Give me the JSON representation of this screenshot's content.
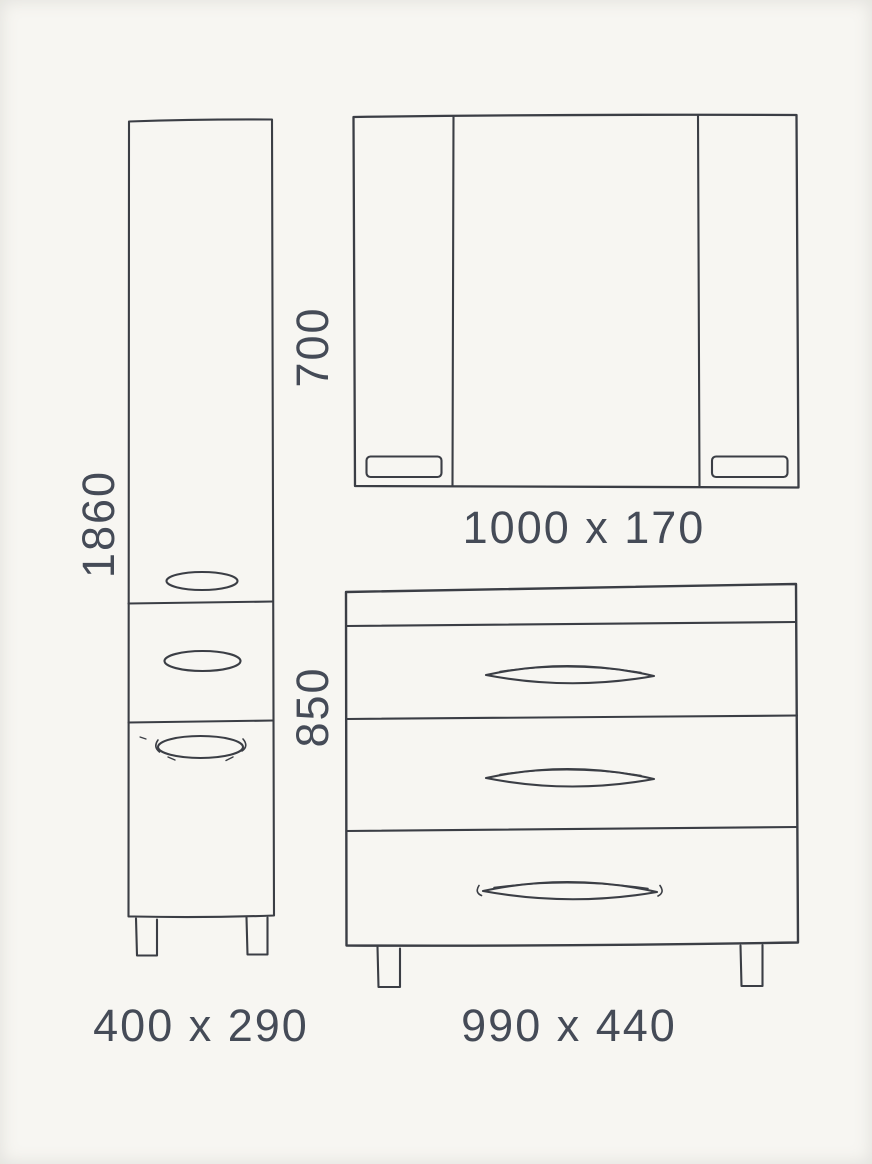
{
  "diagram_type": "hand-drawn furniture dimension drawing, bathroom set front elevations",
  "colors": {
    "background": "#f7f6f2",
    "line": "#3b3e45",
    "text": "#454b57"
  },
  "furniture": [
    {
      "name": "tall side cabinet",
      "height": "1860",
      "footprint": "400 x 290"
    },
    {
      "name": "mirror wall cabinet",
      "height": "700",
      "footprint": "1000 x 170"
    },
    {
      "name": "drawer vanity unit",
      "height": "850",
      "footprint": "990 x 440"
    }
  ]
}
